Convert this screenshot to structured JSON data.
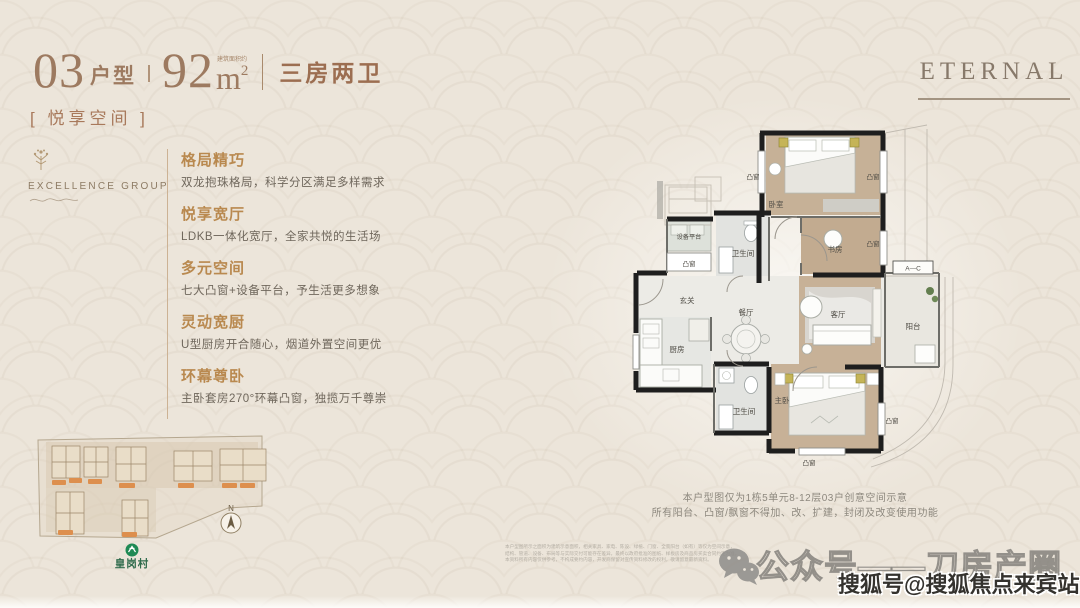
{
  "header": {
    "unit_number": "03",
    "unit_label": "户型",
    "area_value": "92",
    "area_unit": "m",
    "area_sup": "2",
    "area_note": "建筑面积约",
    "rooms_label": "三房两卫",
    "space_label": "[ 悦享空间 ]",
    "brand": "ETERNAL"
  },
  "logo": {
    "group_name": "EXCELLENCE GROUP"
  },
  "features": [
    {
      "title": "格局精巧",
      "desc": "双龙抱珠格局，科学分区满足多样需求"
    },
    {
      "title": "悦享宽厅",
      "desc": "LDKB一体化宽厅，全家共悦的生活场"
    },
    {
      "title": "多元空间",
      "desc": "七大凸窗+设备平台，予生活更多想象"
    },
    {
      "title": "灵动宽厨",
      "desc": "U型厨房开合随心，烟道外置空间更优"
    },
    {
      "title": "环幕尊卧",
      "desc": "主卧套房270°环幕凸窗，独揽万千尊崇"
    }
  ],
  "site_map": {
    "station_label": "皇岗村",
    "compass_label": "N"
  },
  "plan": {
    "labels": {
      "bedroom": "卧室",
      "study": "书房",
      "bath": "卫生间",
      "equip": "设备平台",
      "entry": "玄关",
      "dining": "餐厅",
      "living": "客厅",
      "balcony": "阳台",
      "kitchen": "厨房",
      "master": "主卧",
      "bay": "凸窗",
      "section": "A—C"
    },
    "caption1": "本户型图仅为1栋5单元8-12层03户创意空间示意",
    "caption2": "所有阳台、凸窗/飘窗不得加、改、扩建，封闭及改变使用功能"
  },
  "footer": {
    "disclaimer1": "本户型图所示之面积为建筑示意面积，相关家具、家电、陈设、绿植、门窗、全景阳台（如有）等仅为空间示意，",
    "disclaimer2": "结构、管道、设备、布局等与实际交付可能存在差异，最终以政府批准的图纸、样板房及商品房买卖合同约定为准，",
    "disclaimer3": "本资料所有内容仅供参考，不构成要约内容，开发商保留对宣传资料修改的权利，敬请留意最新资料。",
    "wechat_watermark": "公众号——刀房产圈",
    "sohu_watermark": "搜狐号@搜狐焦点来宾站"
  },
  "colors": {
    "accent_bronze": "#9d7a60",
    "feature_gold": "#b9894f",
    "tan_floor": "#c6b197",
    "station_green": "#2f6b4c",
    "chip_orange": "#dd8f4e"
  }
}
